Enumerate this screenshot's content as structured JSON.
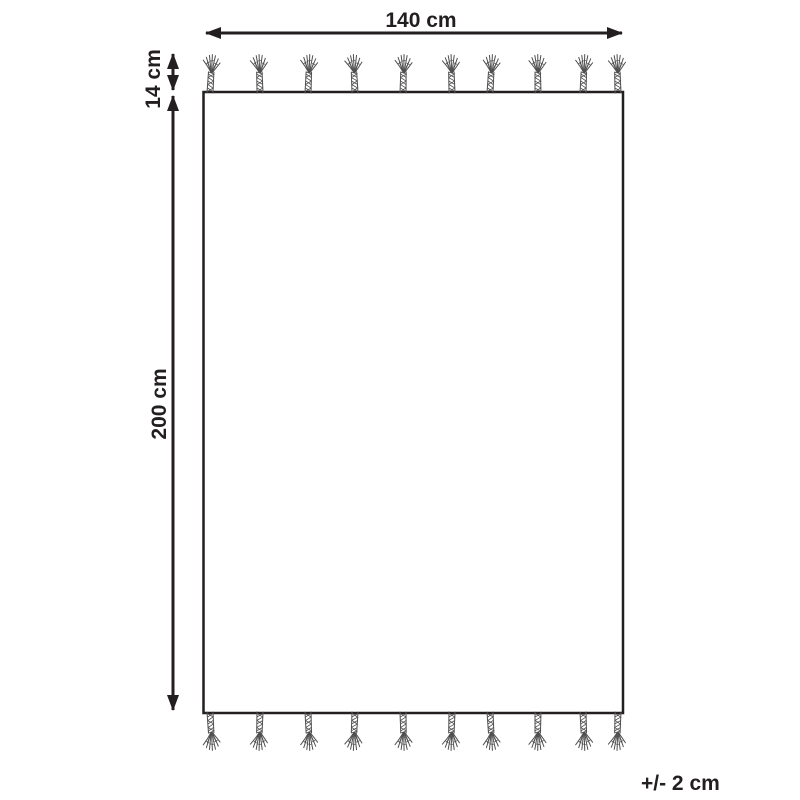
{
  "diagram": {
    "description": "rug-with-tassels-dimension-diagram",
    "labels": {
      "width": "140 cm",
      "fringe": "14 cm",
      "height": "200 cm",
      "tolerance": "+/- 2 cm"
    },
    "fringe": {
      "top_tassel_count": 10,
      "bottom_tassel_count": 10
    },
    "colors": {
      "line": "#231f20",
      "tassel_stroke": "#4f4f4f",
      "background": "#ffffff"
    }
  }
}
